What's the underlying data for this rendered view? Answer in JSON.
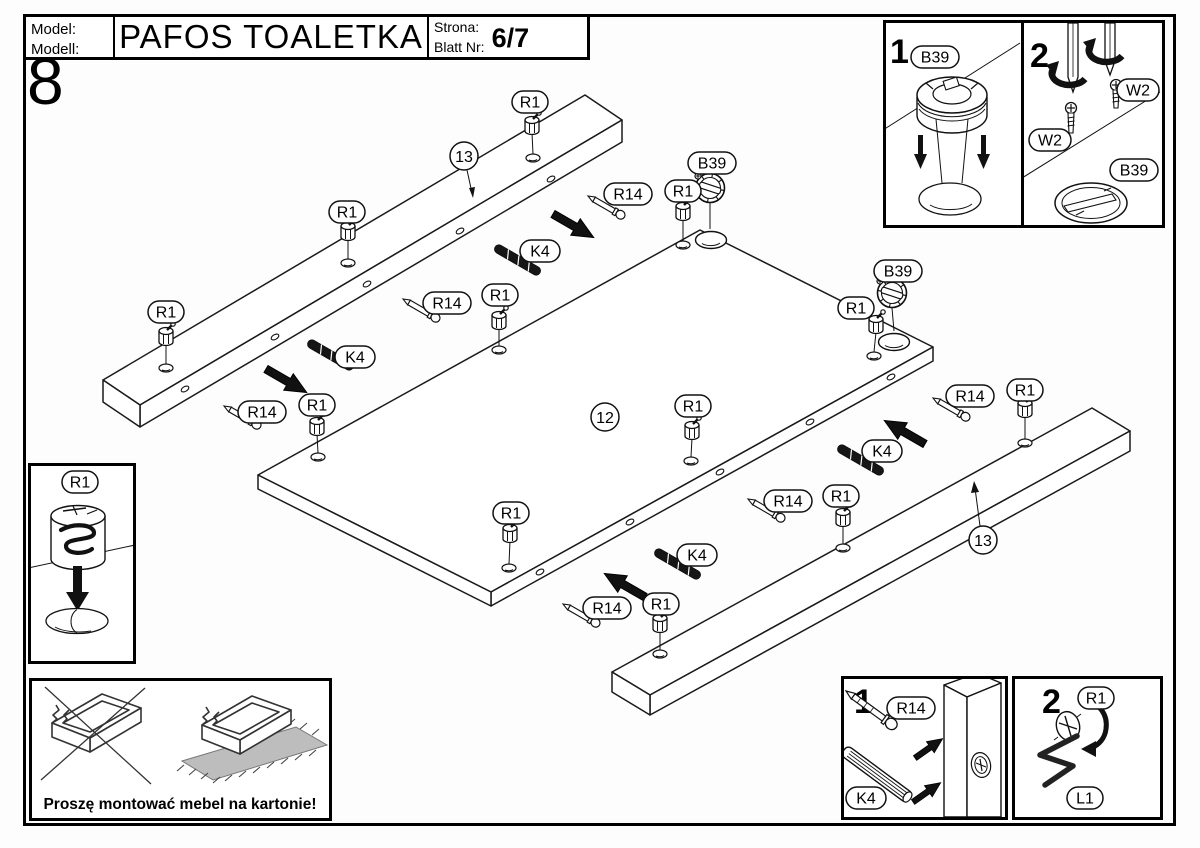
{
  "header": {
    "model_label_line1": "Model:",
    "model_label_line2": "Modell:",
    "title": "PAFOS TOALETKA",
    "page_label_line1": "Strona:",
    "page_label_line2": "Blatt Nr:",
    "page_value": "6/7"
  },
  "step_number": "8",
  "labels": {
    "r1": "R1",
    "r14": "R14",
    "k4": "K4",
    "b39": "B39",
    "w2": "W2",
    "l1": "L1",
    "panel": "12",
    "rail": "13"
  },
  "steps": {
    "one": "1",
    "two": "2"
  },
  "warning": {
    "text": "Proszę montować mebel na kartonie!"
  }
}
